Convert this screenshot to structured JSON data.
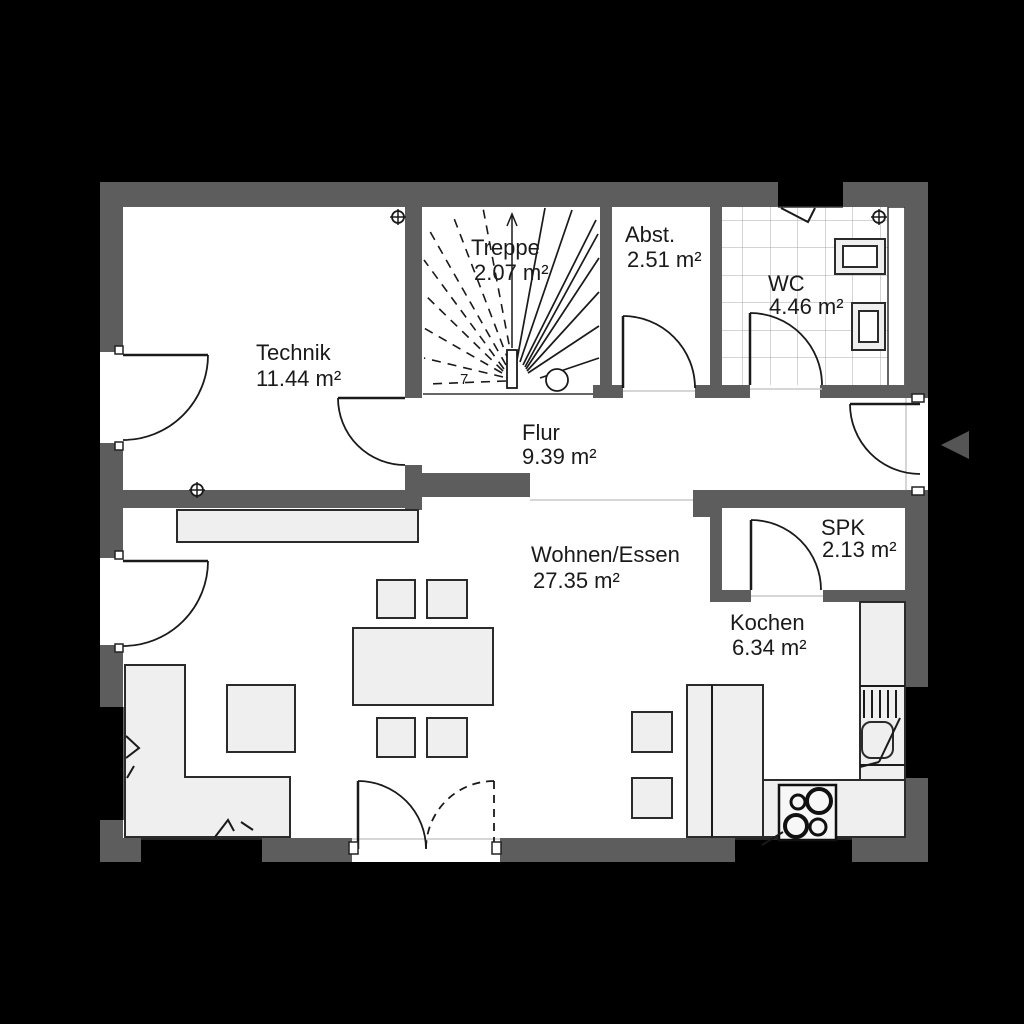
{
  "rooms": [
    {
      "name": "Technik",
      "area": "11.44 m²"
    },
    {
      "name": "Treppe",
      "area": "2.07 m²"
    },
    {
      "name": "Abst.",
      "area": "2.51 m²"
    },
    {
      "name": "WC",
      "area": "4.46 m²"
    },
    {
      "name": "Flur",
      "area": "9.39 m²"
    },
    {
      "name": "Wohnen/Essen",
      "area": "27.35 m²"
    },
    {
      "name": "SPK",
      "area": "2.13 m²"
    },
    {
      "name": "Kochen",
      "area": "6.34 m²"
    }
  ],
  "stairs": {
    "step_number": "7"
  },
  "colors": {
    "background": "#000000",
    "wall": "#5d5d5d",
    "floor": "#ffffff",
    "furniture": "#efefef",
    "line": "#1a1a1a",
    "entrance_arrow": "#555555"
  }
}
